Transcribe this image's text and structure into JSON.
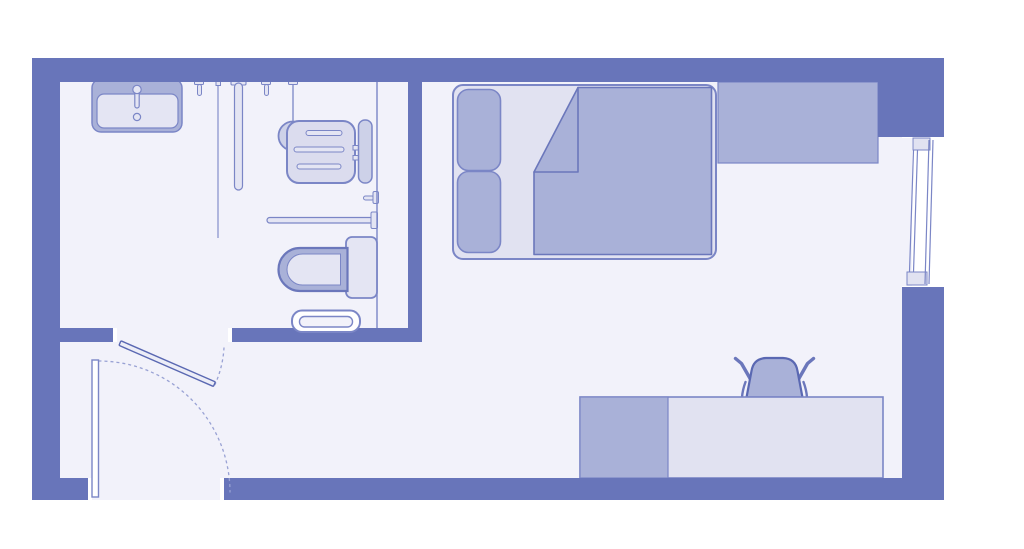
{
  "colors": {
    "background": "#ffffff",
    "wall": "#6875ba",
    "floor": "#f2f2fa",
    "outline": "#7b86c6",
    "outline_strong": "#5a68b2",
    "outline_dark": "#6b77bb",
    "fill_mid": "#a9b1d8",
    "fill_light": "#e4e5f3",
    "fill_frame": "#e1e2f1",
    "fill_soft": "#cdd1e8",
    "fill_seat": "#dbdcee",
    "jamb": "#ffffff",
    "bath_door_leaf": "#ecedf7",
    "dash": "#99a2d4"
  },
  "floor_plan": {
    "type": "studio-room-floor-plan",
    "rooms": [
      {
        "name": "bathroom"
      },
      {
        "name": "bedroom-living-area"
      },
      {
        "name": "entry"
      }
    ],
    "fixtures": [
      {
        "name": "sink"
      },
      {
        "name": "wall-hooks"
      },
      {
        "name": "shower-rail"
      },
      {
        "name": "handheld-shower"
      },
      {
        "name": "shower-seat"
      },
      {
        "name": "grab-bar"
      },
      {
        "name": "shower-valve"
      },
      {
        "name": "toilet"
      },
      {
        "name": "towel-rail"
      },
      {
        "name": "bathroom-door"
      },
      {
        "name": "entrance-door"
      },
      {
        "name": "window"
      },
      {
        "name": "bed"
      },
      {
        "name": "wardrobe"
      },
      {
        "name": "desk"
      },
      {
        "name": "desk-chair"
      }
    ]
  }
}
